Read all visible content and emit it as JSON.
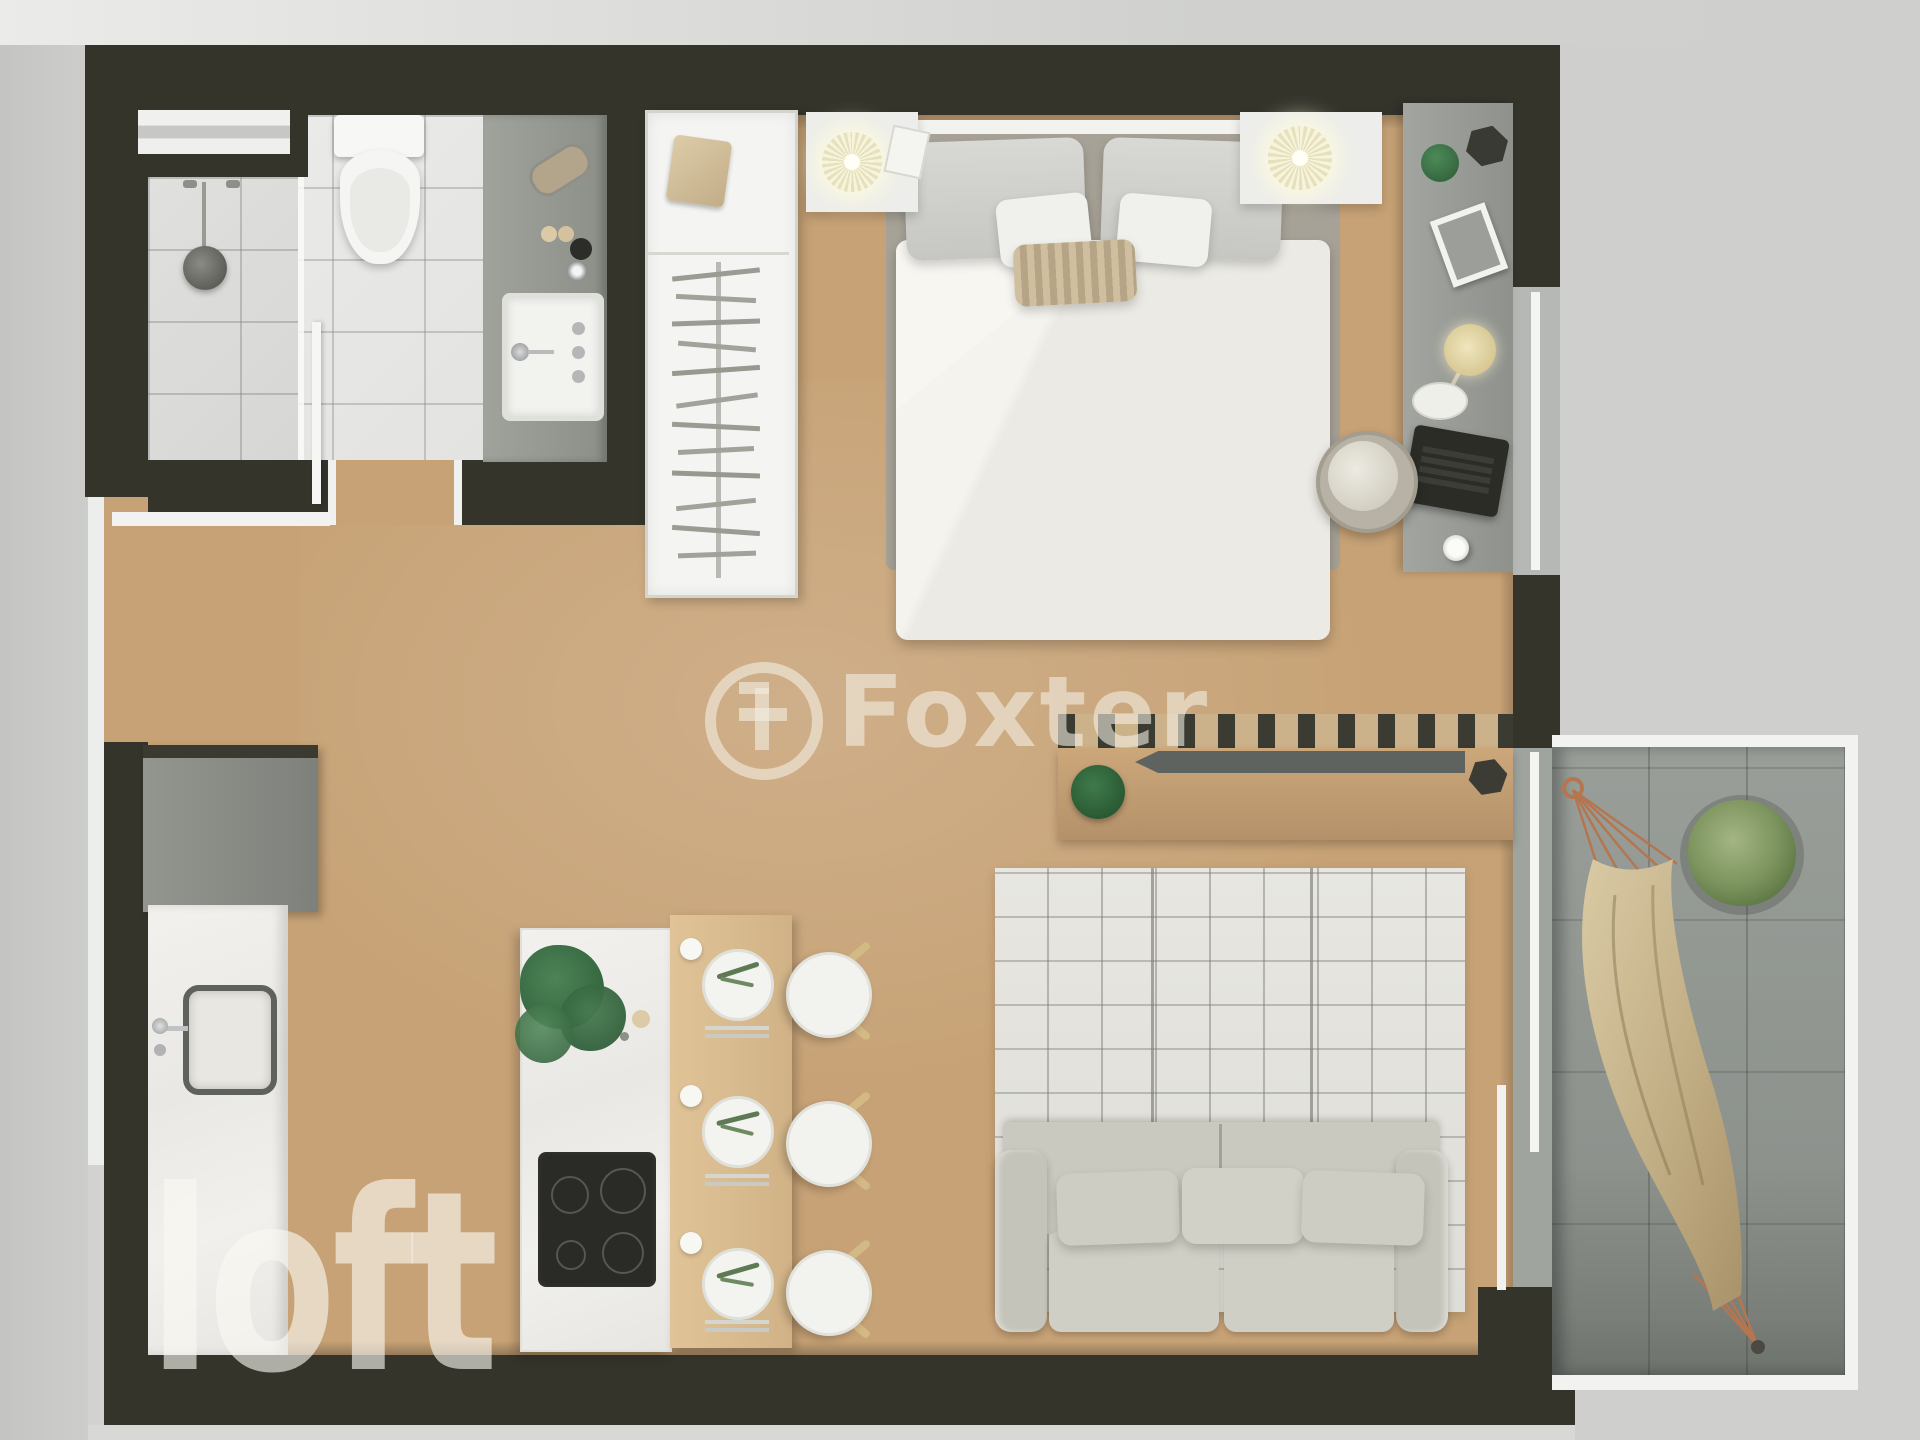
{
  "document": {
    "kind": "floor-plan-render",
    "style": "top-down 3D architectural render",
    "unit_type": "studio apartment"
  },
  "watermarks": {
    "center": {
      "text": "Foxter",
      "logo": "f-monogram-in-circle"
    },
    "corner": {
      "text": "loft"
    }
  },
  "palette": {
    "wall": "#34342b",
    "wood_floor": "#c7a276",
    "bathroom_tile": "#e8e8e6",
    "counter_gray": "#989b94",
    "marble_white": "#f0efec",
    "rug": "#e5e4de",
    "sofa": "#c9c9bf",
    "console_wood": "#c49f72",
    "balcony_floor": "#8f948f",
    "plant_green": "#3c7647",
    "hammock": "#c4b188",
    "exterior": "#d2d3d1"
  },
  "rooms": {
    "bathroom": [
      "window",
      "shower",
      "glass-partition",
      "toilet",
      "vanity-counter",
      "sink",
      "toiletries"
    ],
    "sleeping_area": [
      "wardrobe-with-hangers",
      "double-bed",
      "nightstand-left",
      "nightstand-right",
      "table-lamp-left",
      "table-lamp-right"
    ],
    "work_area": [
      "desk-counter",
      "desk-lamp",
      "laptop",
      "photo-frame",
      "office-chair",
      "window-strip"
    ],
    "living_area": [
      "slatted-console",
      "decor-tray",
      "hex-bowl",
      "plaid-rug",
      "three-seat-sofa"
    ],
    "kitchen_dining": [
      "tall-cabinet",
      "counter-with-sink",
      "island-with-cooktop",
      "island-plant",
      "dining-table",
      "place-settings",
      "three-round-chairs"
    ],
    "balcony": [
      "sliding-door",
      "hammock",
      "potted-plant",
      "railing"
    ]
  }
}
